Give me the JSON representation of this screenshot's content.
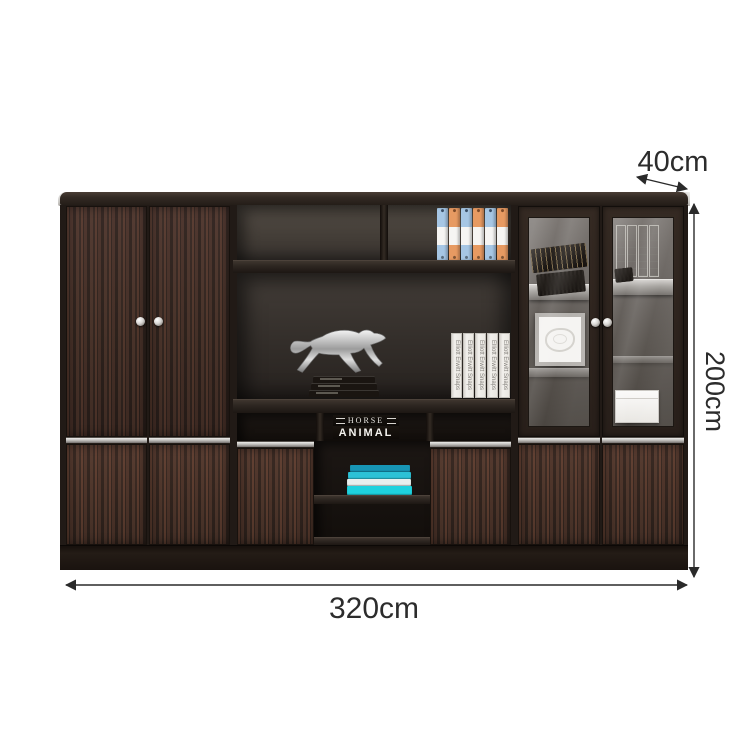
{
  "image": {
    "kind": "furniture product dimension diagram",
    "background": "#ffffff"
  },
  "dimensions": {
    "depth_label": "40cm",
    "height_label": "200cm",
    "width_label": "320cm"
  },
  "cabinet": {
    "decor": {
      "white_books_spine_text": "Elliott Erwitt Snaps",
      "center_book_top": "HORSE",
      "center_book_bottom": "ANIMAL"
    },
    "colors": {
      "wood_dark": "#3b2c25",
      "interior_back": "#443d37",
      "trim_silver": "#c2c0bd",
      "binder_blue": "#a6c6e4",
      "binder_orange": "#e79a62",
      "teal_books": [
        "#1795b5",
        "#2cc2d6",
        "#e8efee",
        "#1ed2de"
      ],
      "sculpture_silver": "#cfcfcf",
      "dimension_line": "#2a2a2a"
    }
  }
}
